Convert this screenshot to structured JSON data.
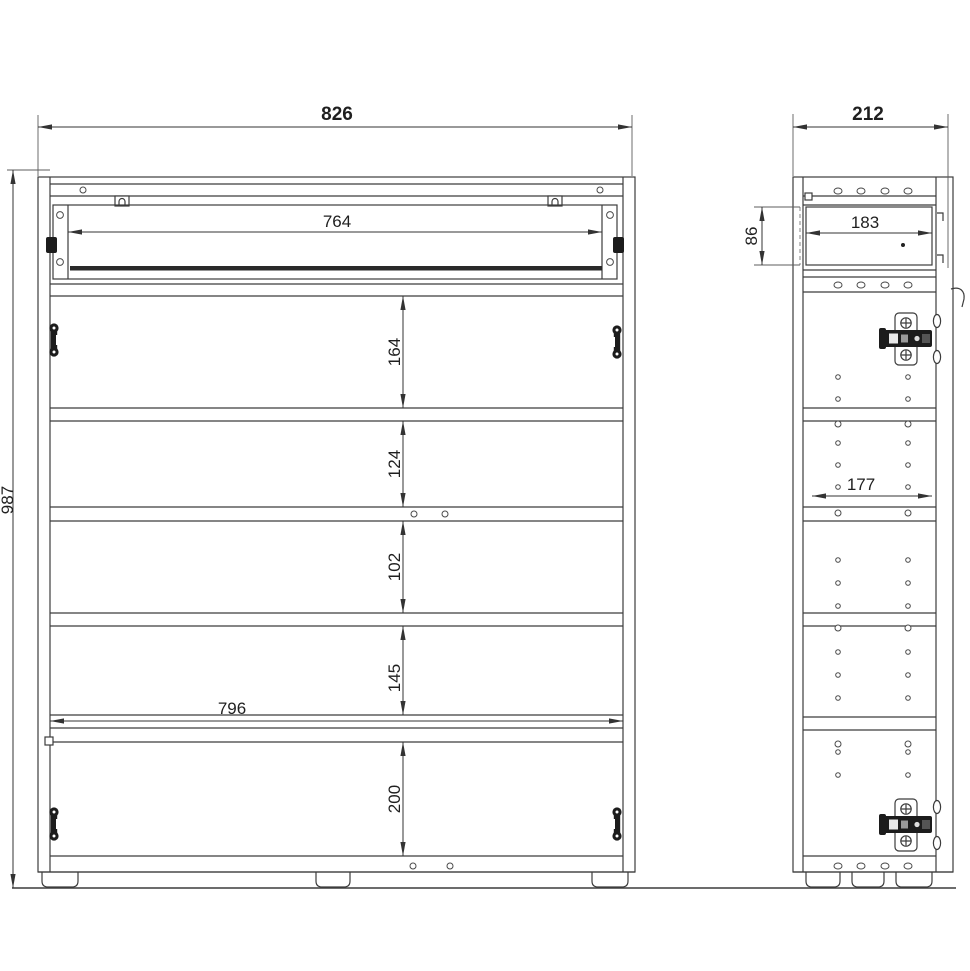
{
  "dimensions": {
    "front": {
      "overall_width": "826",
      "overall_height": "987",
      "drawer_opening_width": "764",
      "shelf_sections_top_to_bottom": [
        "164",
        "124",
        "102",
        "145",
        "200"
      ],
      "interior_width": "796"
    },
    "side": {
      "overall_depth": "212",
      "drawer_depth": "183",
      "drawer_side_height": "86",
      "interior_depth": "177"
    }
  },
  "colors": {
    "line": "#3c3c3c",
    "dimension_text": "#1f1f1f",
    "background": "#ffffff"
  }
}
